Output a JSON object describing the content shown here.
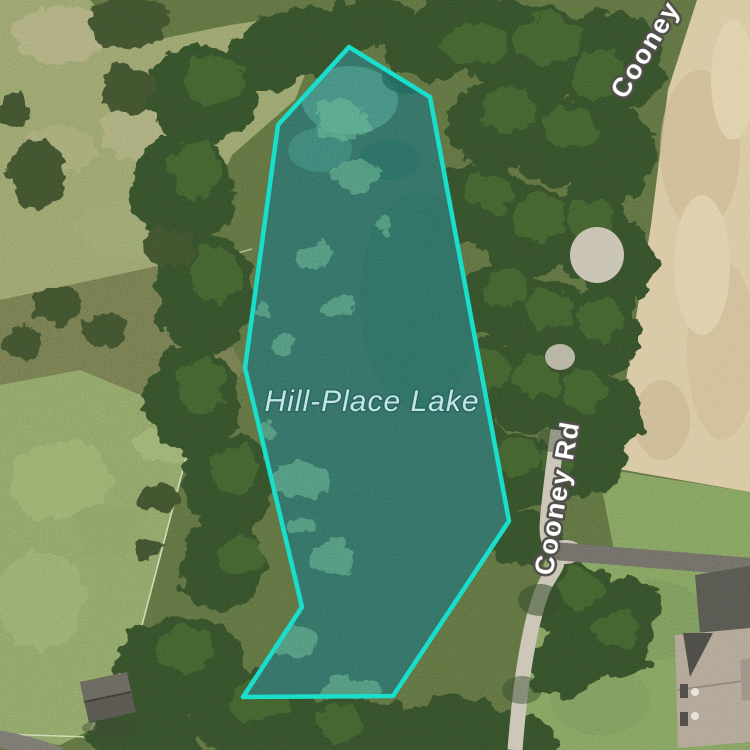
{
  "map": {
    "view_type": "satellite-imagery",
    "selection": {
      "name": "Hill-Place Lake",
      "outline_color": "#17dcc8",
      "fill_color": "rgba(23,220,200,0.17)",
      "label_color": "#c2e6e8"
    },
    "labels": {
      "lake": "Hill-Place Lake",
      "road_side": "Cooney Rd",
      "road_top": "Cooney"
    }
  }
}
